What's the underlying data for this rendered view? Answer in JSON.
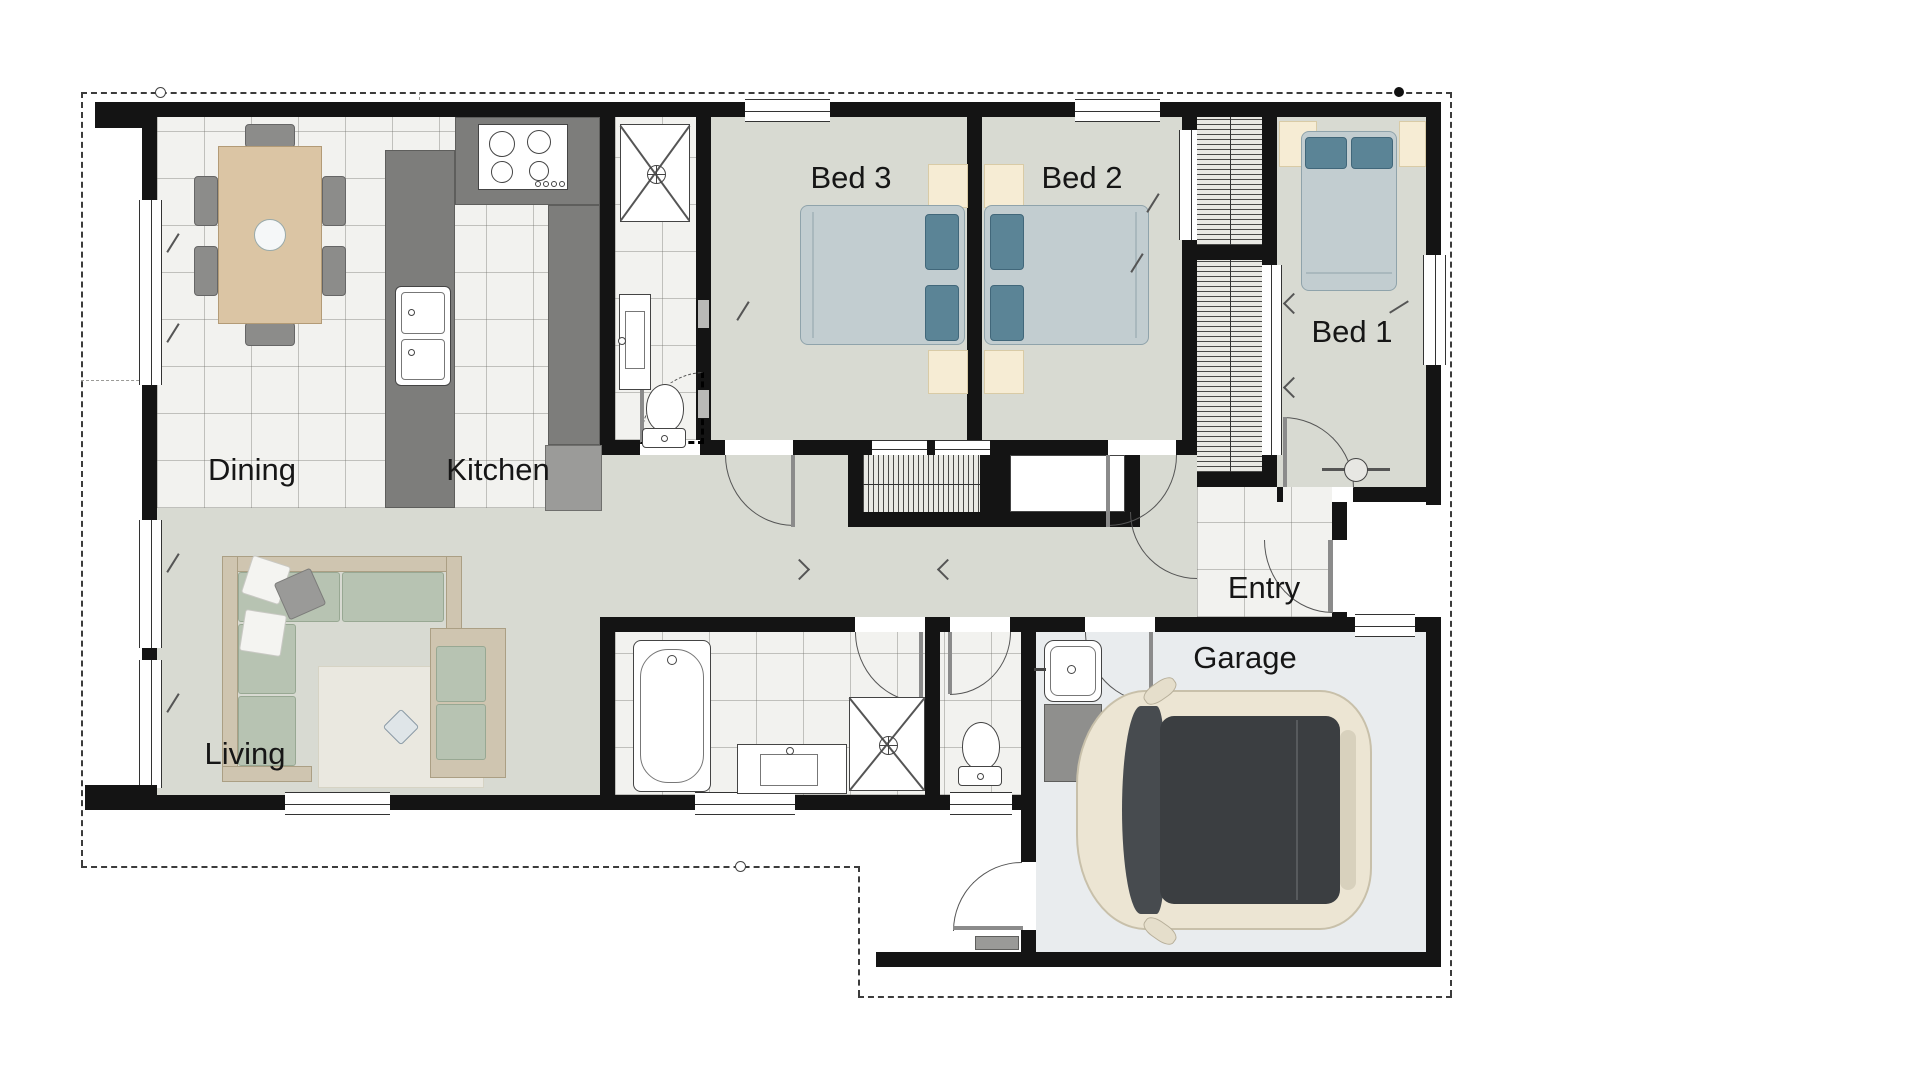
{
  "plan": {
    "title": "Single-storey 3 bedroom house floor plan with garage"
  },
  "rooms": [
    {
      "id": "dining",
      "label": "Dining"
    },
    {
      "id": "kitchen",
      "label": "Kitchen"
    },
    {
      "id": "living",
      "label": "Living"
    },
    {
      "id": "bed3",
      "label": "Bed 3"
    },
    {
      "id": "bed2",
      "label": "Bed 2"
    },
    {
      "id": "bed1",
      "label": "Bed 1"
    },
    {
      "id": "entry",
      "label": "Entry"
    },
    {
      "id": "garage",
      "label": "Garage"
    }
  ],
  "colors": {
    "wall": "#141414",
    "carpet": "#d8dad2",
    "tile": "#f2f2ef",
    "counter": "#7d7d7b",
    "cream": "#f6ecd4",
    "mattress": "#c2cdd0",
    "pillow": "#5b8496",
    "sofaframe": "#cfc5b0",
    "cushion": "#b7c3b2",
    "garage": "#e9ecee",
    "carbody": "#ece5d3",
    "carroof": "#3b3e41",
    "rug": "#eae8e0",
    "tantable": "#dbc5a4"
  },
  "furniture": [
    "dining-table",
    "dining-chair",
    "kitchen-island",
    "island-sink",
    "cooktop",
    "refrigerator",
    "double-bed",
    "pillow",
    "bedside-table",
    "built-in-wardrobe",
    "linen-closet",
    "sofa",
    "armchair",
    "rug",
    "bathtub",
    "vanity-basin",
    "shower",
    "toilet",
    "laundry-tub",
    "car",
    "side-table"
  ]
}
